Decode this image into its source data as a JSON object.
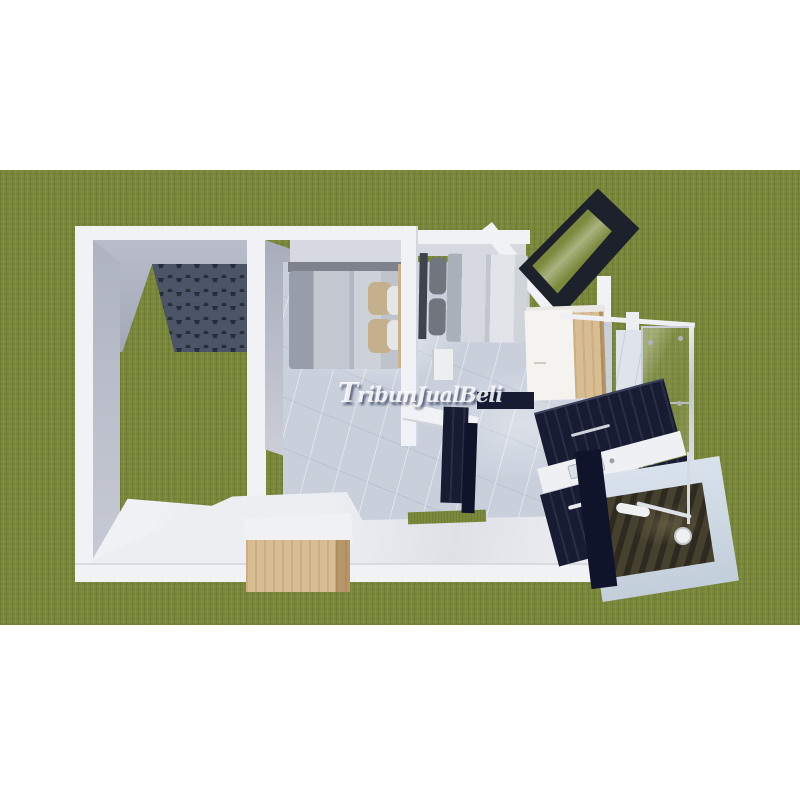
{
  "scene": {
    "description": "3D top-down dollhouse render of a small house floor plan on a grass field, letterboxed with white bars",
    "areas": [
      "courtyard-carport",
      "bedroom-1",
      "bedroom-2",
      "wardrobe",
      "shower-enclosure",
      "kitchen",
      "bathroom",
      "living-area",
      "wood-bench",
      "tilted-corner-window"
    ]
  },
  "watermark": {
    "text": "TribunJualBeli"
  },
  "colors": {
    "letterbox": "#ffffff",
    "grass": "#7b893c",
    "grass-dark": "#6f7d31",
    "grass-light": "#87954b",
    "wall-bright": "#f1f2f5",
    "wall-shadow": "#d7d9e0",
    "marble": "#c9d0dc",
    "marble-light": "#dfe4eb",
    "navy": "#171c33",
    "navy-dark": "#10142a",
    "frame-black": "#1d212c",
    "wood": "#d9bd92",
    "wood-dark": "#c2a172",
    "shingle-base": "#262c3a",
    "shingle-tile": "#4c5567",
    "pillow-tan": "#c5b08d",
    "pillow-white": "#e5e6e8",
    "bath-floor": "#46412f",
    "fixture-white": "#eef0f2",
    "watermark-fill": "rgba(250,250,252,0.88)",
    "watermark-shadow": "rgba(22,32,64,0.60)"
  }
}
